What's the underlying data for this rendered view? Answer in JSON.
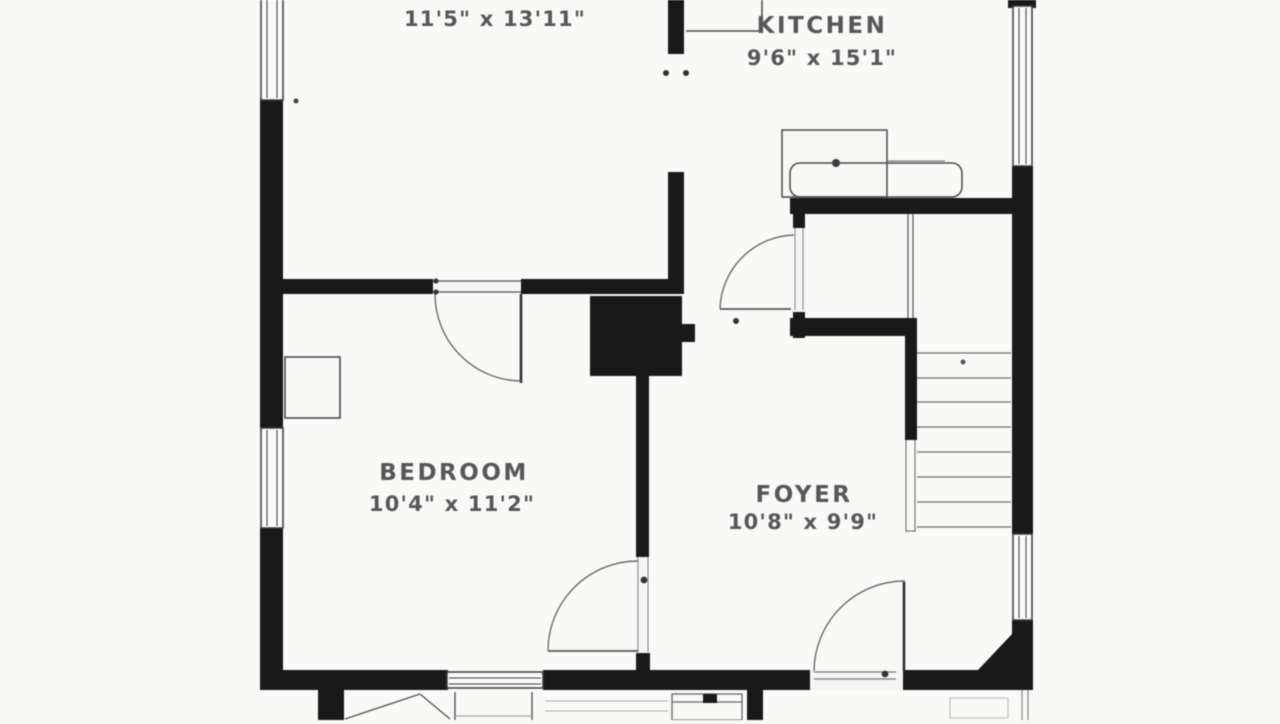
{
  "floor_plan": {
    "rooms": {
      "living": {
        "dims": "11'5\" x 13'11\""
      },
      "kitchen": {
        "name": "KITCHEN",
        "dims": "9'6\" x 15'1\""
      },
      "bedroom": {
        "name": "BEDROOM",
        "dims": "10'4\" x 11'2\""
      },
      "foyer": {
        "name": "FOYER",
        "dims": "10'8\" x 9'9\""
      }
    },
    "stairs": {
      "tread_count": 8
    },
    "colors": {
      "wall": "#161616",
      "line": "#4f4f4f",
      "label_text": "#565656",
      "background": "#f9f9f8"
    }
  }
}
